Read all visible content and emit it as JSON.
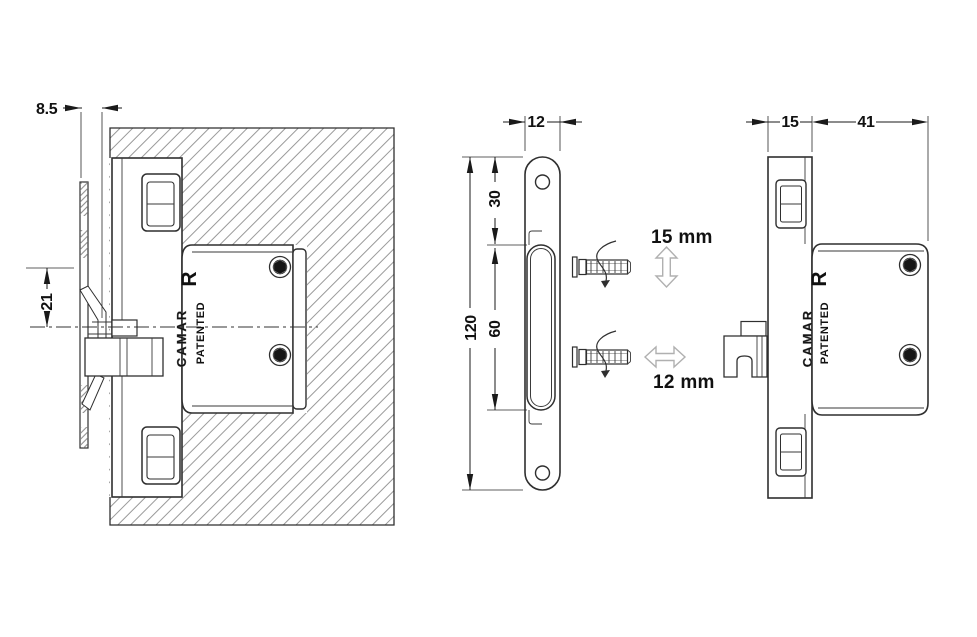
{
  "drawing": {
    "title": "cabinet-hanger-technical-drawing",
    "brand": "CAMAR",
    "patented_label": "PATENTED",
    "logo_letter": "R",
    "section_view": {
      "offset_dim": "8.5",
      "hook_dim": "21"
    },
    "plate_view": {
      "width_dim": "12",
      "top_hole_dim": "30",
      "slot_dim": "60",
      "height_dim": "120"
    },
    "side_view": {
      "depth_dim": "15",
      "length_dim": "41"
    },
    "adjustment": {
      "vertical": "15 mm",
      "horizontal": "12 mm"
    },
    "colors": {
      "line": "#2f2f2f",
      "hatch": "#999999",
      "text": "#111111",
      "background": "#ffffff",
      "light_arrow": "#b0b0b0"
    }
  }
}
